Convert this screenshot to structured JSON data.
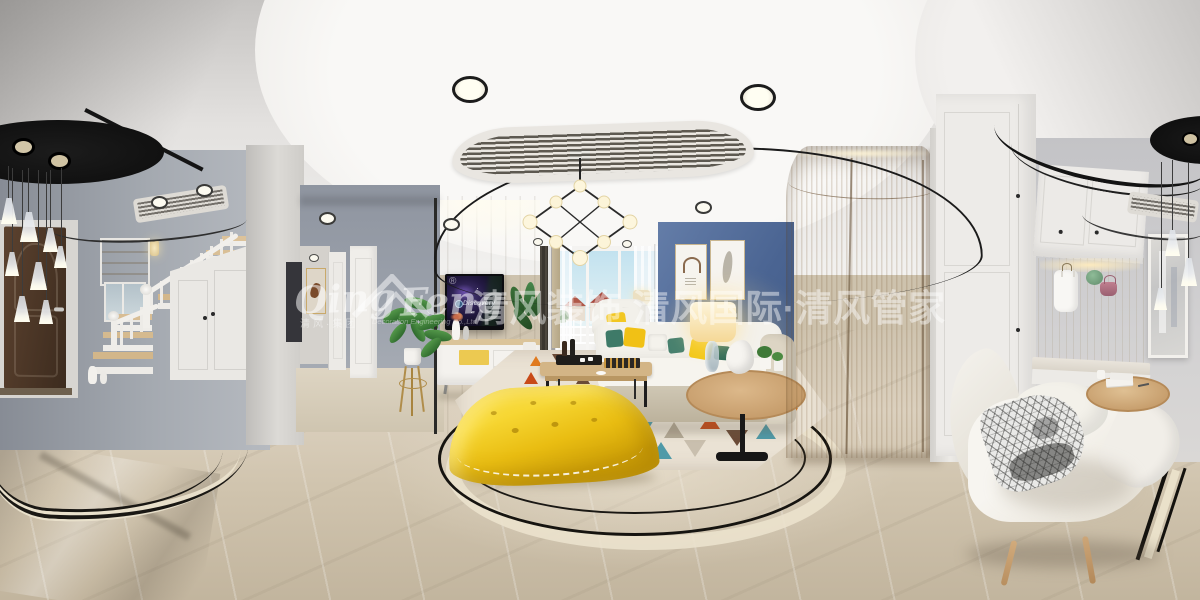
{
  "scene": {
    "description": "360-degree panorama render: foyer with staircase, hallway, living room with yellow ottoman and blue accent wall, wood wardrobe, entry cloakroom with lounge chair"
  },
  "watermark": {
    "logo_qing": "Qing",
    "logo_feng": "Feng",
    "registered": "®",
    "sub_left": "清风·集团",
    "sub_right": "Decoration Engineering Co.,Ltd",
    "main_text": "清风装饰 清风国际·清风管家"
  },
  "tv": {
    "brand": "Discovery"
  },
  "palette": {
    "ceiling_white": "#f4f3f1",
    "wall_grey": "#9aa0a8",
    "accent_blue_wall": "#4a6492",
    "wood_wardrobe": "#c9a877",
    "ottoman_yellow": "#e9c414",
    "pillow_yellow": "#f1c115",
    "pillow_teal": "#3e7a68",
    "rug_orange": "#e07a1f",
    "rug_rust": "#c84a18",
    "rug_teal": "#4f9aa8",
    "rug_brown": "#6b4b37",
    "floor_marble": "#d8cdbb",
    "inlay_black": "#161410",
    "door_brown": "#4a3527",
    "watermark_white": "rgba(255,255,255,0.46)"
  }
}
